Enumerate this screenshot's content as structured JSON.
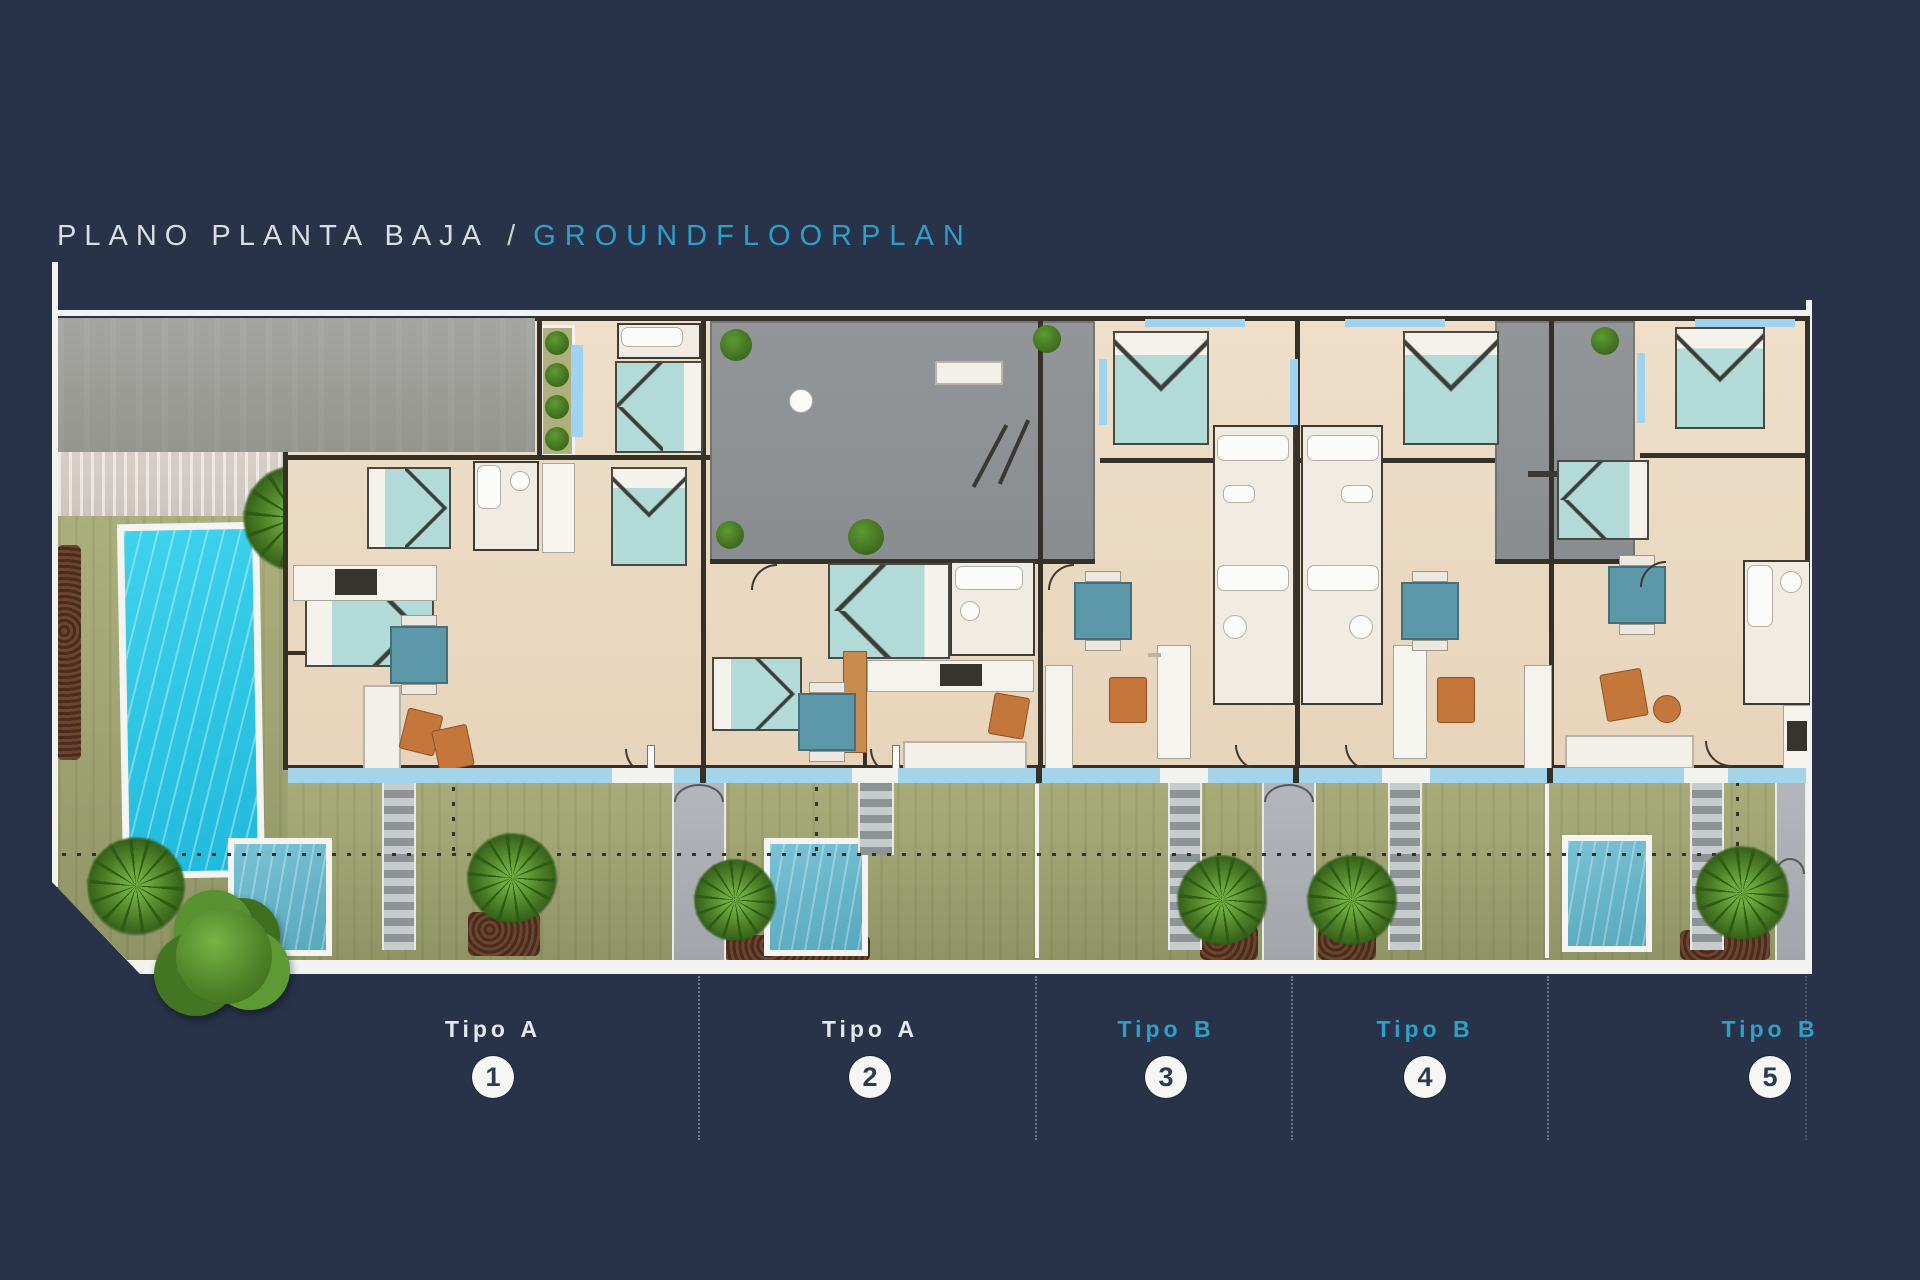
{
  "title": {
    "main": "PLANO PLANTA BAJA",
    "separator": "/",
    "secondary": "GROUNDFLOORPLAN"
  },
  "plan": {
    "units": [
      {
        "type": "Tipo A",
        "number": "1"
      },
      {
        "type": "Tipo A",
        "number": "2"
      },
      {
        "type": "Tipo B",
        "number": "3"
      },
      {
        "type": "Tipo B",
        "number": "4"
      },
      {
        "type": "Tipo B",
        "number": "5"
      }
    ]
  },
  "colors": {
    "background": "#283349",
    "accent_cyan": "#2F9EC9",
    "title_text": "#D9DEE2",
    "lawn": "#A2A674",
    "pool_water": "#27C6E8",
    "plunge_pool_water": "#66B6CA",
    "floor": "#EBD9C2",
    "walls": "#343129",
    "terrace_window": "#9ED4F0",
    "driveway": "#9D9E99",
    "courtyard": "#8F9396",
    "mulch": "#5A3726",
    "vegetation": "#4E8026",
    "bed": "#B2DAD6",
    "dining_table": "#5D98A8",
    "armchair": "#C4763B"
  }
}
